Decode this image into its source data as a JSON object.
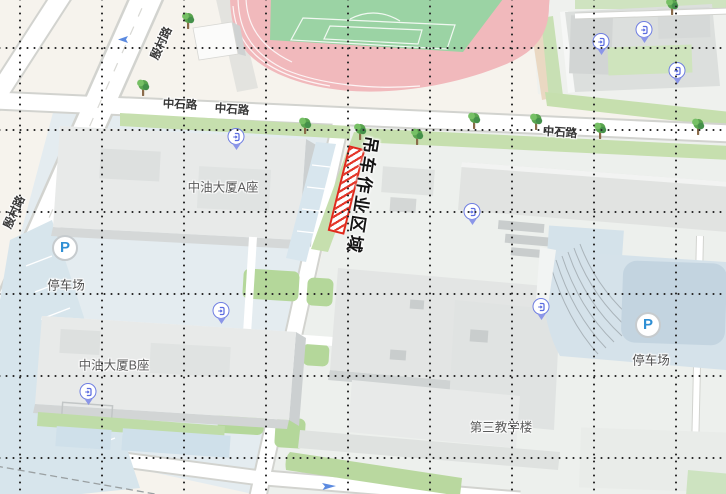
{
  "labels": {
    "road_zhongshi_1": "中石路",
    "road_zhongshi_2": "中石路",
    "road_zhongshi_3": "中石路",
    "road_diagonal_top": "殷村路",
    "road_diagonal_bottom": "殷村路",
    "building_a": "中油大厦A座",
    "building_b": "中油大厦B座",
    "teaching_building": "第三教学楼",
    "parking_left": "停车场",
    "parking_right": "停车场",
    "crane_work_area": "吊车作业区域",
    "parking_letter": "P"
  },
  "icons": {
    "entrance": "door-icon (blue gate marker with pin tail)",
    "parking": "P-in-circle marker",
    "tree": "tree-icon (street tree)",
    "lane_arrow": "blue one-way lane arrow"
  },
  "colors": {
    "background": "#f6f3ed",
    "track_pink": "#f1b9bc",
    "field_green": "#9bd3a4",
    "hedge_green": "#c6dfae",
    "lawn_patch_green": "#b4d79a",
    "plaza_blue": "#e4ecf0",
    "parking_blue": "#c3d4e0",
    "building_gray": "#e8eae9",
    "building_side_gray": "#ccd0d1",
    "road_white": "#ffffff",
    "road_casing": "#d2d3cf",
    "tan_path": "#ead8c2",
    "crane_area_red": "#df2a1c",
    "entrance_blue": "#6f7ee2",
    "parking_p_blue": "#2f8fd4",
    "grid_dot": "#2b2b2b"
  }
}
